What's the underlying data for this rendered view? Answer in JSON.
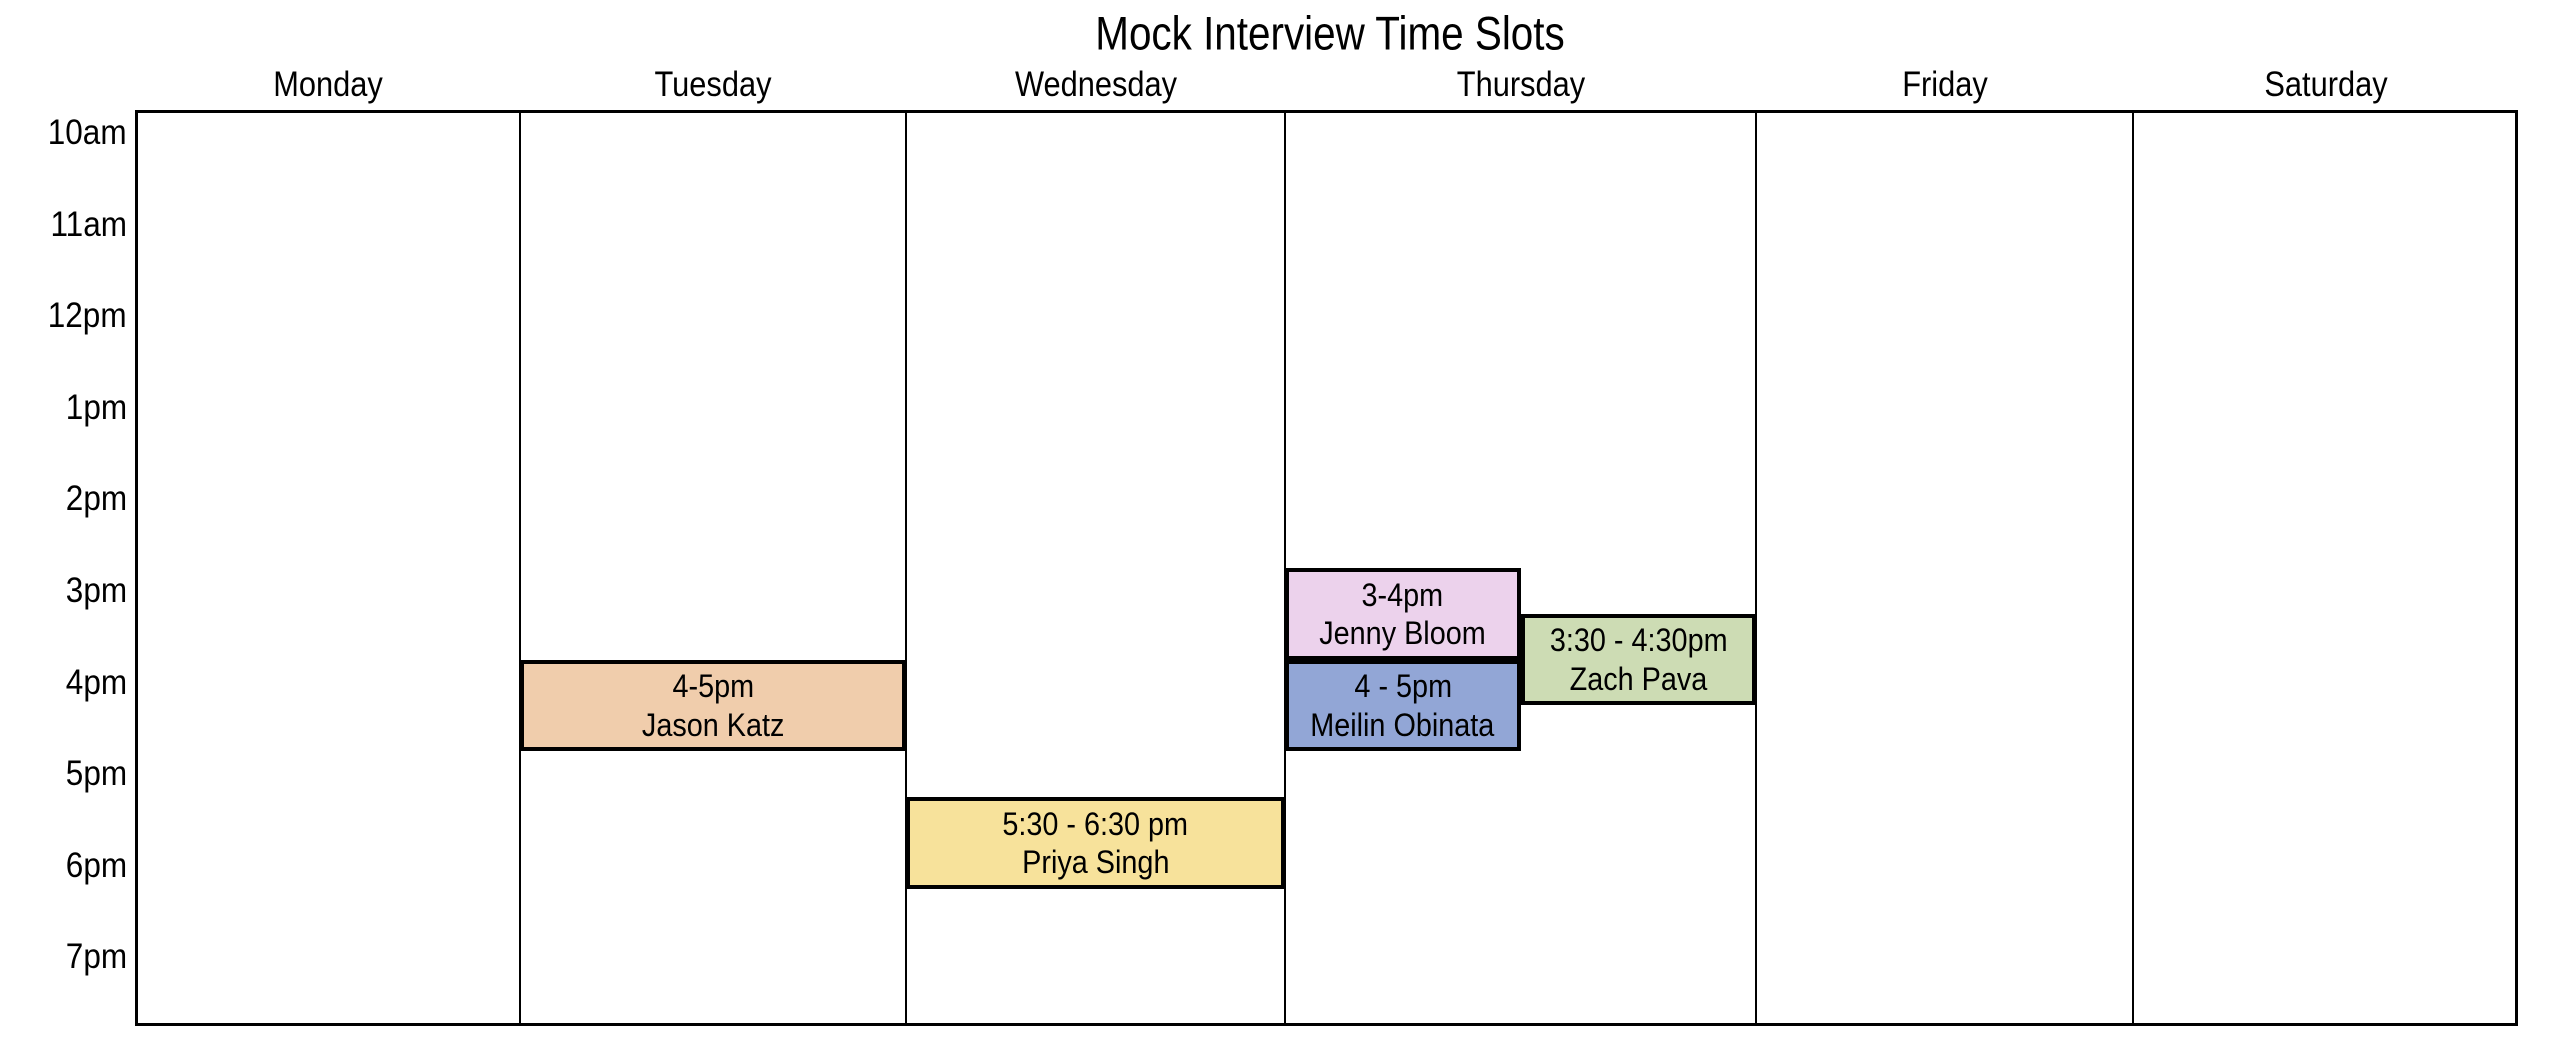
{
  "title": "Mock Interview Time Slots",
  "colors": {
    "background": "#FFFFFF",
    "grid_line": "#000000",
    "event_border": "#000000",
    "text": "#000000"
  },
  "chart_data": {
    "type": "table",
    "title": "Mock Interview Time Slots",
    "x_categories": [
      "Monday",
      "Tuesday",
      "Wednesday",
      "Thursday",
      "Friday",
      "Saturday"
    ],
    "y_tick_labels": [
      "10am",
      "11am",
      "12pm",
      "1pm",
      "2pm",
      "3pm",
      "4pm",
      "5pm",
      "6pm",
      "7pm"
    ],
    "y_axis_range_hours": [
      10,
      20
    ],
    "grid": "vertical day-column dividers only, no horizontal lines, black outer frame",
    "legend": "none",
    "events": [
      {
        "id": "jason-katz",
        "day": "Tuesday",
        "time_label": "4-5pm",
        "person": "Jason Katz",
        "start_hour": 16,
        "end_hour": 17,
        "lane": "full",
        "fill": "#F0CDAC"
      },
      {
        "id": "priya-singh",
        "day": "Wednesday",
        "time_label": "5:30 - 6:30 pm",
        "person": "Priya Singh",
        "start_hour": 17.5,
        "end_hour": 18.5,
        "lane": "full",
        "fill": "#F7E29B"
      },
      {
        "id": "jenny-bloom",
        "day": "Thursday",
        "time_label": "3-4pm",
        "person": "Jenny Bloom",
        "start_hour": 15,
        "end_hour": 16,
        "lane": "left",
        "fill": "#ECD2EC"
      },
      {
        "id": "meilin-obinata",
        "day": "Thursday",
        "time_label": "4 - 5pm",
        "person": "Meilin Obinata",
        "start_hour": 16,
        "end_hour": 17,
        "lane": "left",
        "fill": "#92A6D6"
      },
      {
        "id": "zach-pava",
        "day": "Thursday",
        "time_label": "3:30 - 4:30pm",
        "person": "Zach Pava",
        "start_hour": 15.5,
        "end_hour": 16.5,
        "lane": "right",
        "fill": "#CDDCB4"
      }
    ]
  }
}
